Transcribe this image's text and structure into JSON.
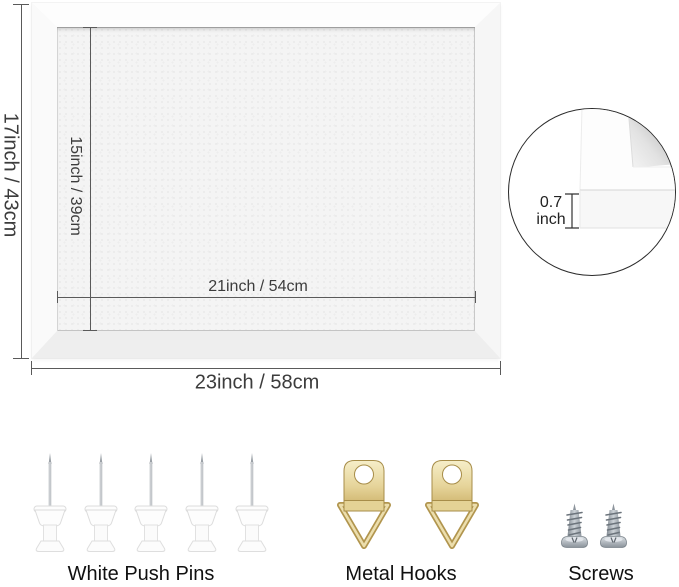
{
  "dimensions": {
    "outer_height": "17inch / 43cm",
    "inner_height": "15inch / 39cm",
    "inner_width": "21inch / 54cm",
    "outer_width": "23inch / 58cm"
  },
  "frame_detail": {
    "thickness_value": "0.7",
    "thickness_unit": "inch"
  },
  "accessories": {
    "push_pins": {
      "label": "White Push Pins",
      "count": 5
    },
    "metal_hooks": {
      "label": "Metal Hooks",
      "count": 2
    },
    "screws": {
      "label": "Screws",
      "count": 2
    }
  },
  "colors": {
    "hook_gold": "#d9c07c",
    "screw_steel": "#9aa2aa",
    "pin_white": "#fdfdfd",
    "dimension_line": "#5a5a5a",
    "felt_surface": "#f4f4f4",
    "frame": "#fbfbfb",
    "label_text": "#101010"
  }
}
